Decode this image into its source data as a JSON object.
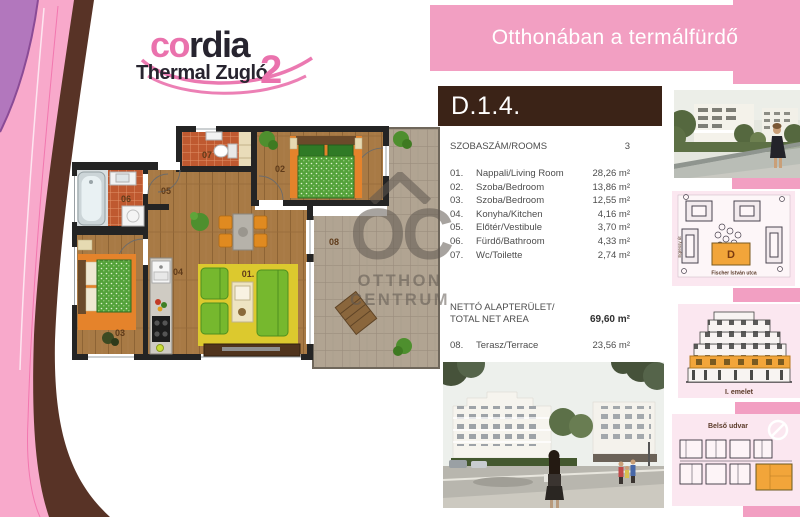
{
  "banner": {
    "text": "Otthonában a termálfürdő"
  },
  "logo": {
    "co": "co",
    "rdia": "rdia",
    "line2": "Thermal Zugló",
    "number": "2"
  },
  "unit": {
    "code": "D.1.4."
  },
  "info": {
    "rooms_label": "SZOBASZÁM/ROOMS",
    "rooms_value": "3",
    "rows": [
      {
        "num": "01.",
        "name": "Nappali/Living Room",
        "area": "28,26 m²"
      },
      {
        "num": "02.",
        "name": "Szoba/Bedroom",
        "area": "13,86 m²"
      },
      {
        "num": "03.",
        "name": "Szoba/Bedroom",
        "area": "12,55 m²"
      },
      {
        "num": "04.",
        "name": "Konyha/Kitchen",
        "area": "4,16 m²"
      },
      {
        "num": "05.",
        "name": "Előtér/Vestibule",
        "area": "3,70 m²"
      },
      {
        "num": "06.",
        "name": "Fürdő/Bathroom",
        "area": "4,33 m²"
      },
      {
        "num": "07.",
        "name": "Wc/Toilette",
        "area": "2,74 m²"
      }
    ],
    "net_label_1": "NETTÓ ALAPTERÜLET/",
    "net_label_2": "TOTAL NET AREA",
    "net_value": "69,60 m²",
    "terrace": {
      "num": "08.",
      "name": "Terasz/Terrace",
      "area": "23,56 m²"
    }
  },
  "plan": {
    "labels": {
      "r01": "01.",
      "r02": "02",
      "r03": "03",
      "r04": "04",
      "r05": "05",
      "r06": "06",
      "r07": "07",
      "r08": "08"
    }
  },
  "watermark": {
    "oc": "OC",
    "line1": "OTTHON",
    "line2": "CENTRUM"
  },
  "side": {
    "site_plan": {
      "building": "D",
      "street_bottom": "Fischer István utca",
      "street_left": "Egressy út"
    },
    "elevation": {
      "caption": "I. emelet"
    },
    "floor_key": {
      "caption": "Belső udvar"
    }
  }
}
